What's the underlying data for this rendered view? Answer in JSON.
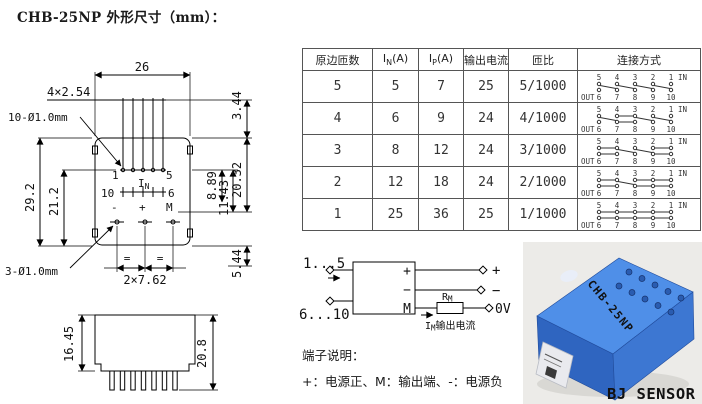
{
  "title": "CHB-25NP 外形尺寸（mm）：",
  "accent_colors": {
    "sensor_blue": "#3d77d2",
    "brand_green": "#00a81c",
    "line_black": "#000000"
  },
  "table": {
    "headers": [
      {
        "text": "原边匝数"
      },
      {
        "pre": "I",
        "sub": "N",
        "post": "(A)"
      },
      {
        "pre": "I",
        "sub": "P",
        "post": "(A)"
      },
      {
        "text": "输出电流"
      },
      {
        "text": "匝比"
      },
      {
        "text": "连接方式"
      }
    ],
    "conn_top_pins": [
      "5",
      "4",
      "3",
      "2",
      "1"
    ],
    "conn_bottom_pins": [
      "6",
      "7",
      "8",
      "9",
      "10"
    ],
    "conn_in_label": "IN",
    "conn_out_label": "OUT",
    "rows": [
      {
        "turns": "5",
        "in_a": "5",
        "ip_a": "7",
        "out_ma": "25",
        "ratio": "5/1000",
        "conn": {
          "d": [
            [
              5,
              7
            ],
            [
              4,
              8
            ],
            [
              3,
              9
            ],
            [
              2,
              10
            ]
          ],
          "t": [],
          "b": []
        }
      },
      {
        "turns": "4",
        "in_a": "6",
        "ip_a": "9",
        "out_ma": "24",
        "ratio": "4/1000",
        "conn": {
          "d": [
            [
              5,
              7
            ],
            [
              3,
              9
            ],
            [
              2,
              10
            ]
          ],
          "t": [
            [
              4,
              3
            ]
          ],
          "b": [
            [
              7,
              8
            ]
          ]
        }
      },
      {
        "turns": "3",
        "in_a": "8",
        "ip_a": "12",
        "out_ma": "24",
        "ratio": "3/1000",
        "conn": {
          "d": [
            [
              4,
              8
            ],
            [
              3,
              9
            ]
          ],
          "t": [
            [
              5,
              4
            ],
            [
              2,
              1
            ]
          ],
          "b": [
            [
              6,
              7
            ],
            [
              9,
              10
            ]
          ]
        }
      },
      {
        "turns": "2",
        "in_a": "12",
        "ip_a": "18",
        "out_ma": "24",
        "ratio": "2/1000",
        "conn": {
          "d": [
            [
              4,
              8
            ]
          ],
          "t": [
            [
              5,
              4
            ],
            [
              3,
              2
            ],
            [
              2,
              1
            ]
          ],
          "b": [
            [
              6,
              7
            ],
            [
              8,
              9
            ],
            [
              9,
              10
            ]
          ]
        }
      },
      {
        "turns": "1",
        "in_a": "25",
        "ip_a": "36",
        "out_ma": "25",
        "ratio": "1/1000",
        "conn": {
          "d": [],
          "t": [
            [
              5,
              4
            ],
            [
              4,
              3
            ],
            [
              3,
              2
            ],
            [
              2,
              1
            ]
          ],
          "b": [
            [
              6,
              7
            ],
            [
              7,
              8
            ],
            [
              8,
              9
            ],
            [
              9,
              10
            ]
          ]
        }
      }
    ]
  },
  "drawing": {
    "front": {
      "width": "26",
      "pin_pitch": "4×2.54",
      "top_holes": "10-Ø1.0mm",
      "height": "29.2",
      "inner_height": "21.2",
      "top_dim": "3.44",
      "dim_889": "8.89",
      "dim_1143": "11.43",
      "dim_2032": "20.32",
      "dim_544": "5.44",
      "bottom_holes": "3-Ø1.0mm",
      "bottom_pitch": "2×7.62",
      "pin1": "1",
      "pin5": "5",
      "pin10": "10",
      "pin6": "6",
      "minus": "-",
      "plus": "+",
      "m": "M",
      "in_pre": "I",
      "in_sub": "N",
      "equal_mark": "="
    },
    "side": {
      "body_height": "16.45",
      "total_height": "20.8"
    }
  },
  "circuit": {
    "primary_in": "1...5",
    "primary_out": "6...10",
    "box_plus": "+",
    "box_minus": "−",
    "box_m": "M",
    "out_plus": "+",
    "out_minus": "−",
    "out_zero": "0V",
    "rm_pre": "R",
    "rm_sub": "M",
    "caption_pre": "I",
    "caption_sub": "M",
    "caption_post": "输出电流"
  },
  "terminal_note": {
    "heading": "端子说明：",
    "body": "+：电源正、M：输出端、-：电源负"
  },
  "photo": {
    "model": "CHB-25NP",
    "brand": "BJ SENSOR"
  }
}
